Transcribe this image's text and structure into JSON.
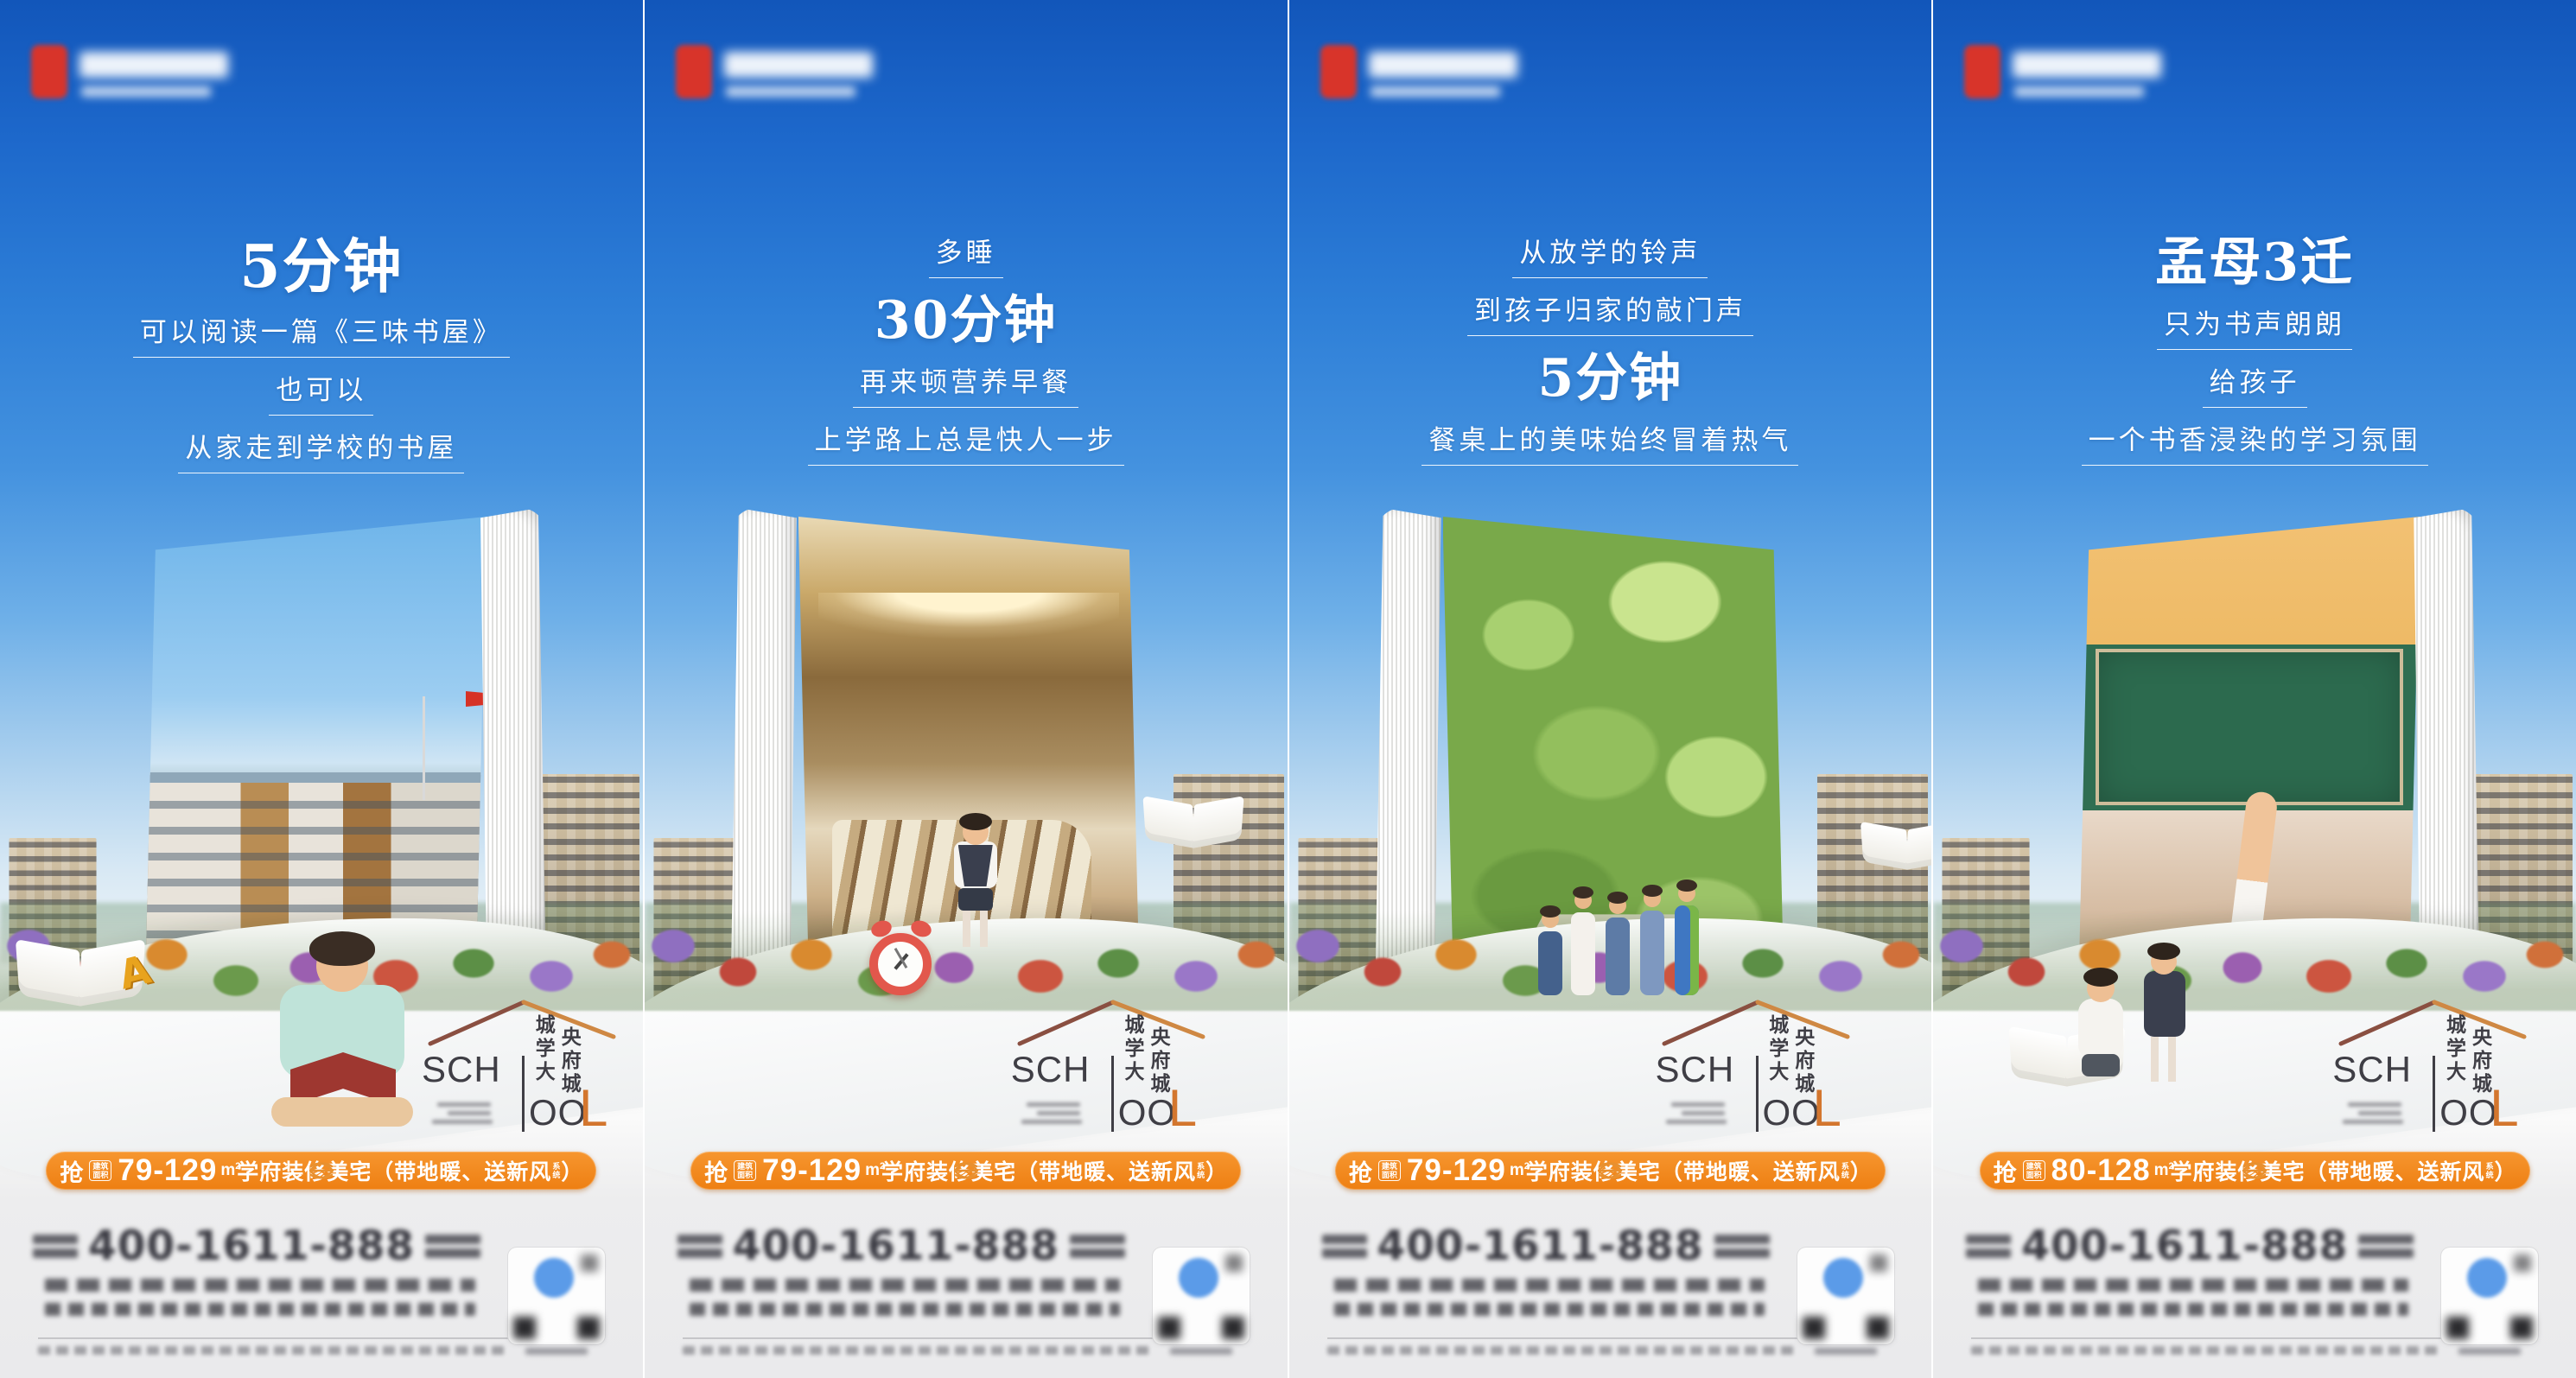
{
  "shared": {
    "school_logo": {
      "sch": "SCH",
      "ool": "OO",
      "l": "L",
      "col_left": "城学大",
      "col_right": "央府城"
    },
    "banner": {
      "grab": "抢",
      "badge_top": "建筑",
      "badge_bottom": "面积",
      "unit_base": "m",
      "unit_sup": "2",
      "body": "学府装修美宅（带地暖、送新风",
      "small_top": "系",
      "small_bottom": "统",
      "close": "）"
    },
    "footer": {
      "phone": "400-1611-888"
    },
    "colors": {
      "banner_orange": "#ef8220",
      "school_l_orange": "#d3762e",
      "sky_blue": "#1f6ccd",
      "logo_red": "#d8342a"
    }
  },
  "posters": [
    {
      "id": 1,
      "scene": "school",
      "page_side": "right",
      "area": "79-129",
      "lines": [
        {
          "type": "headline",
          "text": "5分钟"
        },
        {
          "type": "sub",
          "text": "可以阅读一篇《三味书屋》"
        },
        {
          "type": "sub",
          "text": "也可以"
        },
        {
          "type": "sub",
          "text": "从家走到学校的书屋"
        }
      ]
    },
    {
      "id": 2,
      "scene": "bedroom",
      "page_side": "left",
      "area": "79-129",
      "lines": [
        {
          "type": "sub",
          "text": "多睡"
        },
        {
          "type": "headline",
          "text": "30分钟"
        },
        {
          "type": "sub",
          "text": "再来顿营养早餐"
        },
        {
          "type": "sub",
          "text": "上学路上总是快人一步"
        }
      ]
    },
    {
      "id": 3,
      "scene": "park",
      "page_side": "left",
      "area": "79-129",
      "lines": [
        {
          "type": "sub",
          "text": "从放学的铃声"
        },
        {
          "type": "sub",
          "text": "到孩子归家的敲门声"
        },
        {
          "type": "headline",
          "text": "5分钟"
        },
        {
          "type": "sub",
          "text": "餐桌上的美味始终冒着热气"
        }
      ]
    },
    {
      "id": 4,
      "scene": "classroom",
      "page_side": "right",
      "area": "80-128",
      "lines": [
        {
          "type": "headline",
          "text": "孟母3迁"
        },
        {
          "type": "sub",
          "text": "只为书声朗朗"
        },
        {
          "type": "sub",
          "text": "给孩子"
        },
        {
          "type": "sub",
          "text": "一个书香浸染的学习氛围"
        }
      ]
    }
  ]
}
